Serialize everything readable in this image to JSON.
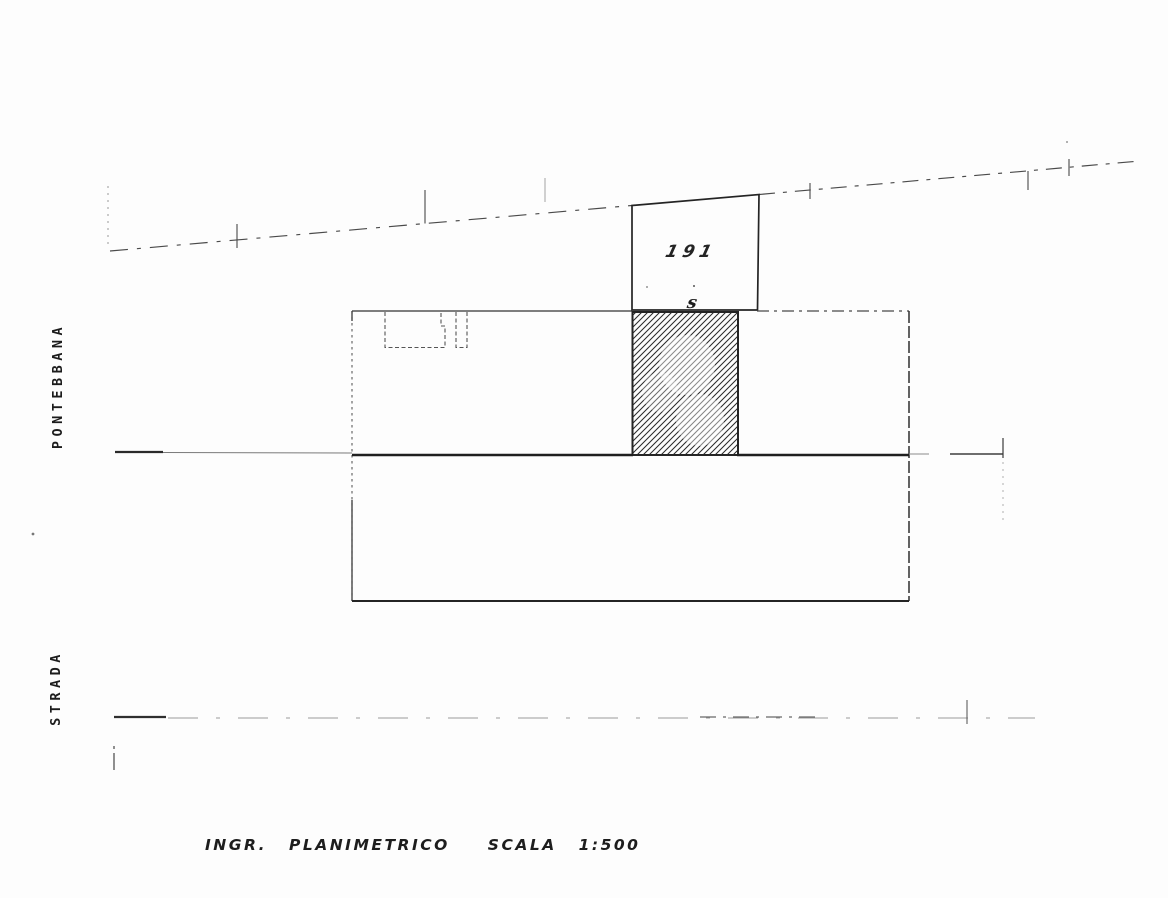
{
  "page": {
    "background": "#fdfdfd",
    "ink": "#1f1f1f"
  },
  "left_margin_labels": {
    "top": "PONTEBBANA",
    "bottom": "STRADA"
  },
  "parcel": {
    "number": "191",
    "mark": "s"
  },
  "caption": {
    "title": "INGR. PLANIMETRICO",
    "scale": "SCALA 1:500"
  }
}
